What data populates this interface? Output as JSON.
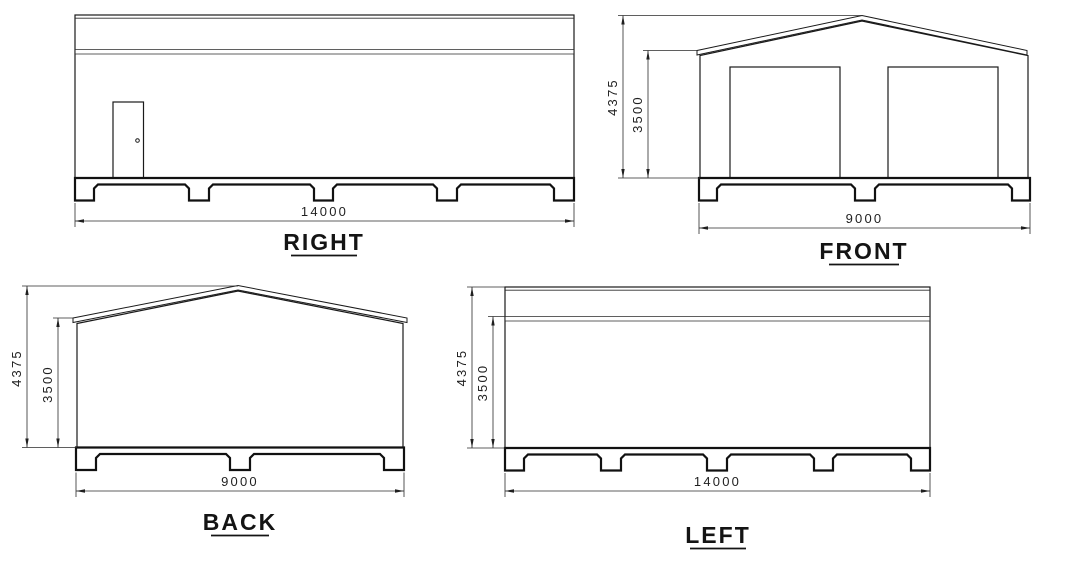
{
  "views": {
    "right": {
      "label": "RIGHT",
      "dims": {
        "width": "14000"
      }
    },
    "front": {
      "label": "FRONT",
      "dims": {
        "width": "9000",
        "total_height": "4375",
        "eave_height": "3500"
      }
    },
    "back": {
      "label": "BACK",
      "dims": {
        "width": "9000",
        "total_height": "4375",
        "eave_height": "3500"
      }
    },
    "left": {
      "label": "LEFT",
      "dims": {
        "width": "14000",
        "total_height": "4375",
        "eave_height": "3500"
      }
    }
  },
  "colors": {
    "line": "#1a1a1a",
    "corrugation_dark": "#4a4a4a",
    "corrugation_light": "#b4b4b4",
    "background": "#ffffff"
  }
}
